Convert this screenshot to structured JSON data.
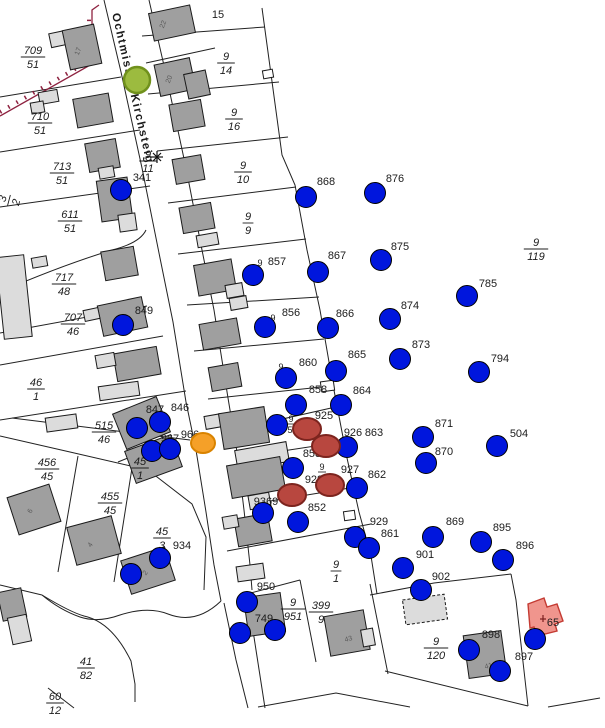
{
  "street": {
    "name": "Ochtmisser Kirchsteig"
  },
  "colors": {
    "blue_dot": "#0016dd",
    "blue_stroke": "#000000",
    "red_dot": "#b8473f",
    "red_stroke": "#7c241e",
    "orange_dot": "#f5a028",
    "orange_stroke": "#d98300",
    "green_dot": "#9cbb3f",
    "green_stroke": "#70911c",
    "building_dark": "#9f9f9f",
    "building_light": "#dcdcdc",
    "building_stroke": "#1a1a1a",
    "highlight_pink": "#f0958d",
    "highlight_pink_stroke": "#c43b33",
    "boundary_line": "#222222",
    "sheet_boundary_red": "#8e2240",
    "label_color": "#1c1c1c"
  },
  "point_labels": [
    [
      "15",
      218,
      18
    ],
    [
      "341",
      142,
      181
    ],
    [
      "868",
      326,
      185
    ],
    [
      "876",
      395,
      182
    ],
    [
      "9",
      260,
      266,
      9,
      0
    ],
    [
      "857",
      277,
      265
    ],
    [
      "867",
      337,
      259
    ],
    [
      "875",
      400,
      250
    ],
    [
      "9",
      273,
      321,
      9,
      0
    ],
    [
      "856",
      291,
      316
    ],
    [
      "866",
      345,
      317
    ],
    [
      "874",
      410,
      309
    ],
    [
      "785",
      488,
      287
    ],
    [
      "873",
      421,
      348
    ],
    [
      "794",
      500,
      362
    ],
    [
      "9",
      281,
      370,
      9,
      1
    ],
    [
      "860",
      308,
      366
    ],
    [
      "865",
      357,
      358
    ],
    [
      "858",
      318,
      393
    ],
    [
      "864",
      362,
      394
    ],
    [
      "849",
      144,
      314
    ],
    [
      "847",
      155,
      413
    ],
    [
      "846",
      180,
      411
    ],
    [
      "967",
      170,
      442
    ],
    [
      "966",
      190,
      438
    ],
    [
      "925",
      324,
      419
    ],
    [
      "9",
      291,
      422,
      9,
      1
    ],
    [
      "5",
      290,
      433,
      9,
      0
    ],
    [
      "926",
      353,
      436
    ],
    [
      "863",
      374,
      436
    ],
    [
      "871",
      444,
      427
    ],
    [
      "870",
      444,
      455
    ],
    [
      "504",
      519,
      437
    ],
    [
      "853",
      312,
      457
    ],
    [
      "9",
      322,
      470,
      9,
      1
    ],
    [
      "927",
      350,
      473
    ],
    [
      "862",
      377,
      478
    ],
    [
      "928",
      314,
      483
    ],
    [
      "9369",
      266,
      505
    ],
    [
      "852",
      317,
      511
    ],
    [
      "929",
      379,
      525
    ],
    [
      "861",
      390,
      537
    ],
    [
      "869",
      455,
      525
    ],
    [
      "895",
      502,
      531
    ],
    [
      "896",
      525,
      549
    ],
    [
      "901",
      425,
      558
    ],
    [
      "902",
      441,
      580
    ],
    [
      "934",
      182,
      549
    ],
    [
      "950",
      266,
      590
    ],
    [
      "749",
      264,
      622
    ],
    [
      "898",
      491,
      638
    ],
    [
      "897",
      524,
      660
    ],
    [
      "65",
      553,
      626
    ]
  ],
  "parcel_fractions": [
    [
      "709",
      "51",
      33,
      56,
      0
    ],
    [
      "710",
      "51",
      40,
      122,
      0
    ],
    [
      "713",
      "51",
      62,
      172,
      0
    ],
    [
      "611",
      "51",
      70,
      220,
      0
    ],
    [
      "3",
      "2",
      8,
      200,
      -75
    ],
    [
      "717",
      "48",
      64,
      283,
      0
    ],
    [
      "707",
      "46",
      73,
      323,
      0
    ],
    [
      "46",
      "1",
      36,
      388,
      0
    ],
    [
      "515",
      "46",
      104,
      431,
      0
    ],
    [
      "456",
      "45",
      47,
      468,
      0
    ],
    [
      "455",
      "45",
      110,
      502,
      0
    ],
    [
      "45",
      "1",
      140,
      467,
      0
    ],
    [
      "45",
      "3",
      162,
      537,
      0
    ],
    [
      "41",
      "82",
      86,
      667,
      0
    ],
    [
      "60",
      "12",
      55,
      702,
      0
    ],
    [
      "9",
      "11",
      148,
      160,
      0
    ],
    [
      "9",
      "14",
      226,
      62,
      0
    ],
    [
      "9",
      "16",
      234,
      118,
      0
    ],
    [
      "9",
      "10",
      243,
      171,
      0
    ],
    [
      "9",
      "9",
      248,
      222,
      0
    ],
    [
      "9",
      "119",
      536,
      248,
      0
    ],
    [
      "9",
      "1",
      336,
      570,
      0
    ],
    [
      "399",
      "9",
      321,
      611,
      0
    ],
    [
      "9",
      "951",
      293,
      608,
      0
    ],
    [
      "9",
      "120",
      436,
      647,
      0
    ]
  ],
  "dots_blue": [
    [
      121,
      190
    ],
    [
      306,
      197
    ],
    [
      375,
      193
    ],
    [
      253,
      275
    ],
    [
      318,
      272
    ],
    [
      381,
      260
    ],
    [
      265,
      327
    ],
    [
      328,
      328
    ],
    [
      390,
      319
    ],
    [
      467,
      296
    ],
    [
      400,
      359
    ],
    [
      479,
      372
    ],
    [
      286,
      378
    ],
    [
      336,
      371
    ],
    [
      296,
      405
    ],
    [
      341,
      405
    ],
    [
      123,
      325
    ],
    [
      137,
      428
    ],
    [
      160,
      422
    ],
    [
      152,
      451
    ],
    [
      170,
      449
    ],
    [
      277,
      425
    ],
    [
      293,
      468
    ],
    [
      347,
      447
    ],
    [
      423,
      437
    ],
    [
      426,
      463
    ],
    [
      497,
      446
    ],
    [
      357,
      488
    ],
    [
      263,
      513
    ],
    [
      298,
      522
    ],
    [
      355,
      537
    ],
    [
      369,
      548
    ],
    [
      433,
      537
    ],
    [
      481,
      542
    ],
    [
      503,
      560
    ],
    [
      403,
      568
    ],
    [
      421,
      590
    ],
    [
      160,
      558
    ],
    [
      131,
      574
    ],
    [
      247,
      602
    ],
    [
      275,
      630
    ],
    [
      240,
      633
    ],
    [
      535,
      639
    ],
    [
      469,
      650
    ],
    [
      500,
      671
    ]
  ],
  "dots_red": [
    [
      307,
      429
    ],
    [
      326,
      446
    ],
    [
      330,
      485
    ],
    [
      292,
      495
    ]
  ],
  "dot_orange": {
    "x": 203,
    "y": 443,
    "rx": 12,
    "ry": 10
  },
  "dot_green": {
    "x": 137,
    "y": 80,
    "r": 13
  },
  "buildings": [
    [
      50,
      32,
      17,
      14,
      "l",
      -12,
      0
    ],
    [
      66,
      27,
      32,
      40,
      "d",
      -12,
      0
    ],
    [
      151,
      9,
      42,
      28,
      "d",
      -12,
      0
    ],
    [
      157,
      61,
      36,
      32,
      "d",
      -12,
      0
    ],
    [
      186,
      72,
      22,
      25,
      "d",
      -12,
      0
    ],
    [
      39,
      91,
      19,
      12,
      "l",
      -10,
      0
    ],
    [
      31,
      102,
      13,
      11,
      "l",
      -10,
      0
    ],
    [
      75,
      96,
      36,
      29,
      "d",
      -10,
      0
    ],
    [
      171,
      102,
      32,
      27,
      "d",
      -10,
      0
    ],
    [
      87,
      141,
      31,
      29,
      "d",
      -10,
      0
    ],
    [
      99,
      167,
      15,
      11,
      "l",
      -10,
      0
    ],
    [
      174,
      157,
      29,
      25,
      "d",
      -10,
      0
    ],
    [
      99,
      179,
      31,
      41,
      "d",
      -8,
      0
    ],
    [
      119,
      214,
      17,
      17,
      "l",
      -8,
      0
    ],
    [
      181,
      205,
      32,
      26,
      "d",
      -10,
      0
    ],
    [
      197,
      234,
      21,
      12,
      "l",
      -10,
      0
    ],
    [
      103,
      249,
      33,
      29,
      "d",
      -10,
      0
    ],
    [
      32,
      257,
      15,
      10,
      "l",
      -10,
      0
    ],
    [
      0,
      256,
      28,
      82,
      "l",
      -6,
      0
    ],
    [
      100,
      301,
      45,
      31,
      "d",
      -12,
      0
    ],
    [
      84,
      309,
      15,
      11,
      "l",
      -12,
      0
    ],
    [
      196,
      262,
      38,
      31,
      "d",
      -10,
      0
    ],
    [
      226,
      284,
      17,
      13,
      "l",
      -10,
      0
    ],
    [
      230,
      297,
      17,
      12,
      "l",
      -10,
      0
    ],
    [
      115,
      350,
      44,
      28,
      "d",
      -10,
      0
    ],
    [
      96,
      354,
      19,
      13,
      "l",
      -10,
      0
    ],
    [
      99,
      384,
      40,
      14,
      "l",
      -8,
      0
    ],
    [
      201,
      321,
      38,
      26,
      "d",
      -10,
      0
    ],
    [
      210,
      365,
      30,
      24,
      "d",
      -10,
      0
    ],
    [
      46,
      416,
      31,
      14,
      "l",
      -8,
      0
    ],
    [
      118,
      404,
      47,
      38,
      "d",
      -22,
      0
    ],
    [
      129,
      442,
      49,
      34,
      "d",
      -20,
      0
    ],
    [
      205,
      415,
      17,
      13,
      "l",
      -10,
      0
    ],
    [
      221,
      410,
      46,
      36,
      "d",
      -9,
      0
    ],
    [
      236,
      446,
      52,
      20,
      "l",
      -10,
      0
    ],
    [
      229,
      461,
      54,
      33,
      "d",
      -10,
      0
    ],
    [
      249,
      494,
      21,
      14,
      "l",
      -10,
      0
    ],
    [
      236,
      516,
      34,
      28,
      "d",
      -10,
      0
    ],
    [
      223,
      516,
      15,
      12,
      "l",
      -10,
      0
    ],
    [
      237,
      565,
      27,
      15,
      "l",
      -8,
      0
    ],
    [
      246,
      595,
      37,
      39,
      "d",
      -8,
      0
    ],
    [
      12,
      490,
      44,
      39,
      "d",
      -18,
      0
    ],
    [
      71,
      521,
      46,
      39,
      "d",
      -15,
      0
    ],
    [
      125,
      553,
      46,
      35,
      "d",
      -18,
      0
    ],
    [
      0,
      590,
      24,
      29,
      "d",
      -12,
      0
    ],
    [
      10,
      616,
      19,
      27,
      "l",
      -12,
      0
    ],
    [
      327,
      613,
      40,
      40,
      "d",
      -10,
      0
    ],
    [
      362,
      629,
      12,
      17,
      "l",
      -10,
      0
    ],
    [
      404,
      597,
      42,
      25,
      "l",
      -8,
      1
    ],
    [
      466,
      633,
      38,
      43,
      "d",
      -8,
      0
    ]
  ],
  "building_numbers": [
    [
      "17",
      80,
      52,
      -70
    ],
    [
      "22",
      165,
      25,
      -70
    ],
    [
      "20",
      171,
      80,
      -70
    ],
    [
      "6",
      32,
      512,
      -60
    ],
    [
      "4",
      92,
      546,
      -55
    ],
    [
      "2",
      147,
      574,
      -55
    ],
    [
      "43",
      349,
      641,
      -15
    ],
    [
      "41",
      489,
      668,
      -15
    ]
  ],
  "white_sheds": [
    [
      321,
      381,
      13,
      10,
      -8
    ],
    [
      344,
      511,
      11,
      9,
      -8
    ],
    [
      263,
      70,
      10,
      8,
      -10
    ]
  ],
  "boundary_lines": [
    "M0,97 L121,77",
    "M0,152 L140,130",
    "M0,207 L150,186",
    "M0,292 Q60,266 112,250 Q140,243 146,230",
    "M0,333 L147,306",
    "M0,365 L163,336",
    "M0,420 L186,391",
    "M12,418 L190,440",
    "M0,436 L70,452 L148,470",
    "M148,470 L192,504 L206,537 L204,590",
    "M118,462 L162,444",
    "M78,456 L58,572",
    "M132,468 L114,582",
    "M104,0 L121,72 L142,168 L160,258 L173,322 L186,402 L196,450 L206,512 L214,565 L221,601",
    "M149,0 L165,70 L186,168 L202,250 L214,310 L228,398 L237,452 L244,510 L250,565 L252,590",
    "M224,603 L236,660 L248,708",
    "M247,592 L256,650 L265,708",
    "M221,601 Q196,625 168,614 Q148,606 120,615 Q98,623 80,617 Q60,610 42,595",
    "M42,595 Q70,612 84,616 Q112,622 131,661 L135,684 L135,702",
    "M0,585 L42,595",
    "M48,688 L74,708",
    "M262,8 L282,155 L295,185 L307,250 L320,310 L333,385 L347,458 L359,512 L371,556 L377,594",
    "M142,36 L265,27",
    "M146,63 L215,48",
    "M148,94 L279,82",
    "M157,151 L288,137",
    "M168,203 L296,187",
    "M178,254 L306,239",
    "M187,305 L319,297",
    "M194,351 L324,339",
    "M208,399 L331,386",
    "M225,432 L340,406",
    "M250,456 L348,441",
    "M252,504 L356,487",
    "M227,551 L371,524",
    "M370,595 L434,583 L511,574",
    "M511,574 L516,600 L528,706",
    "M385,671 L528,706",
    "M300,580 L316,662",
    "M370,584 L388,674",
    "M258,707 L336,693 L410,707",
    "M548,707 L600,698",
    "M247,594 L300,580"
  ],
  "sheet_boundary": {
    "solid": "M0,116 L92,64 L92,10 L99,5",
    "ticks": "M0,112 L89,61 L89,12"
  },
  "highlight_building": {
    "path": "M528,604 L544,598 L547,607 L557,604 L563,621 L555,624 L557,631 L537,636 L534,627 L530,628 Z"
  },
  "markers": {
    "star": {
      "x": 157,
      "y": 157
    },
    "cross": {
      "x": 543,
      "y": 619
    }
  }
}
